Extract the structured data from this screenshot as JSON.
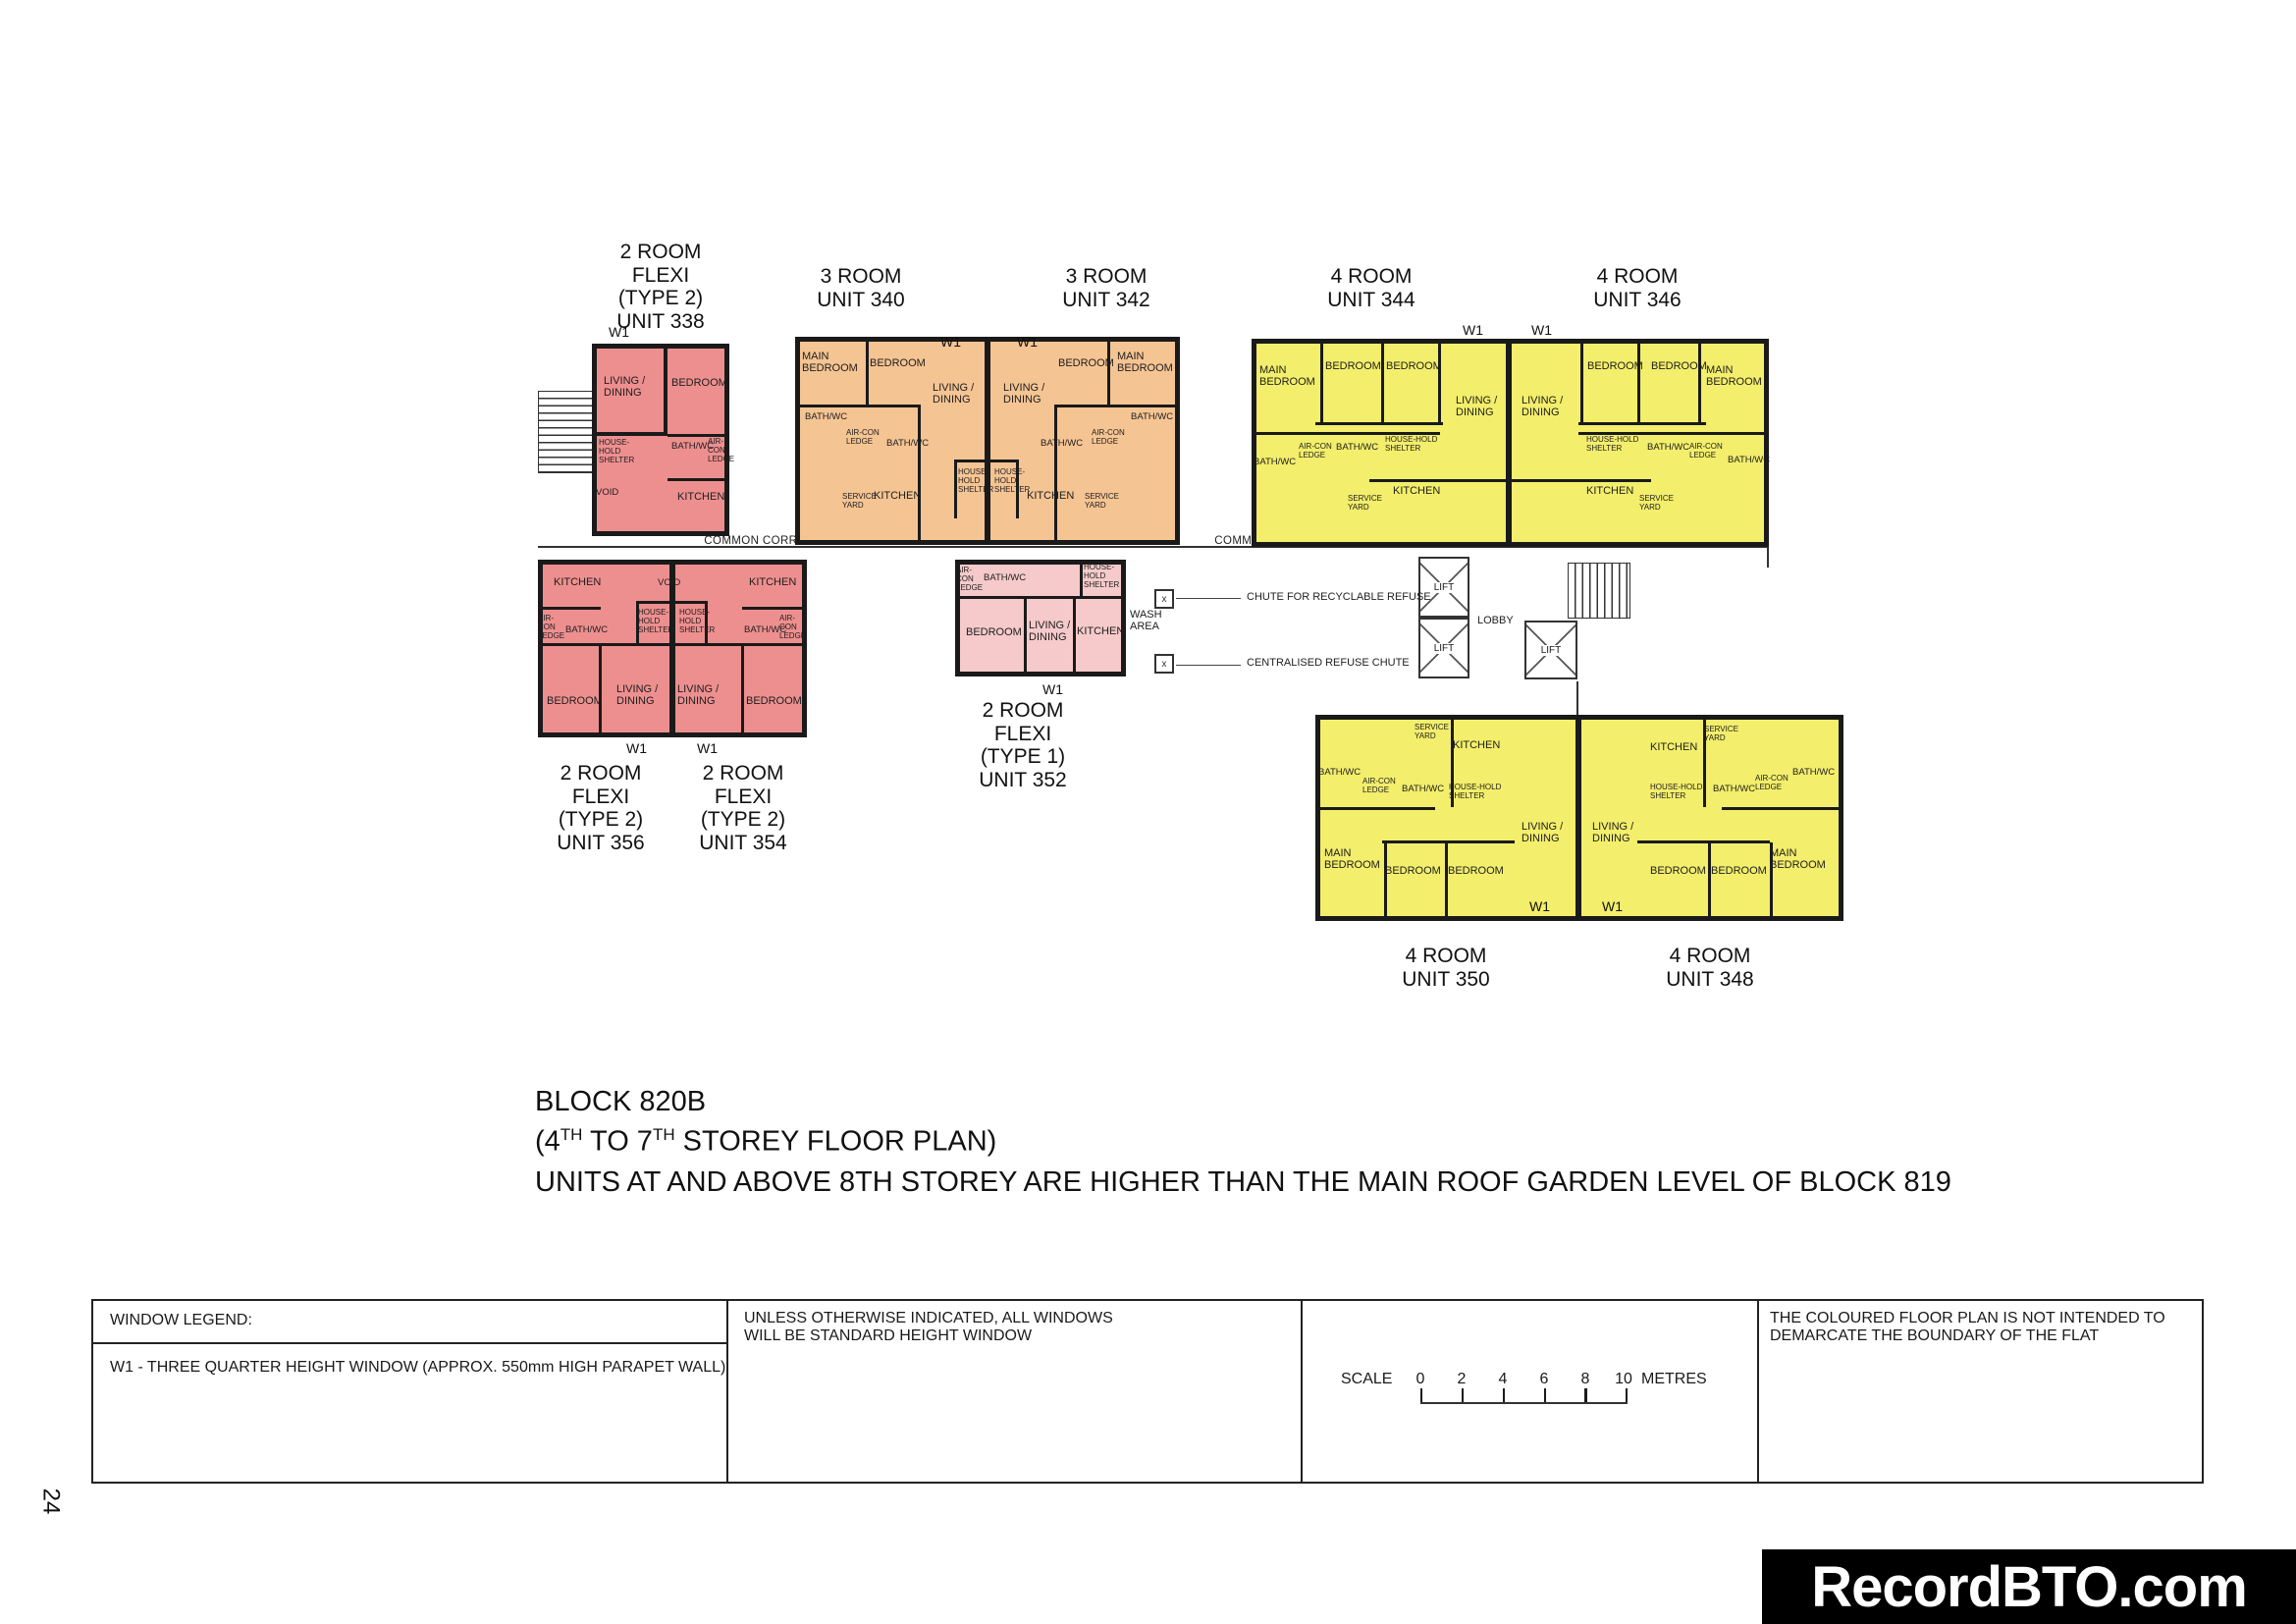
{
  "page": {
    "number": "24",
    "watermark": "RecordBTO.com"
  },
  "title": {
    "block": "BLOCK 820B",
    "storey_parts": [
      "(4",
      "TH",
      " TO 7",
      "TH",
      " STOREY FLOOR PLAN)"
    ],
    "note": "UNITS AT AND ABOVE 8TH STOREY ARE HIGHER THAN THE MAIN ROOF GARDEN LEVEL OF BLOCK 819"
  },
  "labels": {
    "living_dining": "LIVING /\nDINING",
    "bedroom": "BEDROOM",
    "main_bedroom": "MAIN\nBEDROOM",
    "kitchen": "KITCHEN",
    "bath_wc": "BATH/WC",
    "household_shelter": "HOUSE-HOLD\nSHELTER",
    "service_yard": "SERVICE\nYARD",
    "aircon_ledge": "AIR-CON\nLEDGE",
    "void": "VOID",
    "wash_area": "WASH\nAREA",
    "w1": "W1",
    "lift": "LIFT",
    "lobby": "LOBBY",
    "common_corridor": "COMMON CORRIDOR",
    "chute_recyclable": "CHUTE FOR RECYCLABLE REFUSE",
    "chute_centralised": "CENTRALISED REFUSE CHUTE",
    "chute_mark": "x"
  },
  "units": {
    "u338": {
      "caption": "2 ROOM\nFLEXI\n(TYPE 2)\nUNIT 338"
    },
    "u340": {
      "caption": "3 ROOM\nUNIT 340"
    },
    "u342": {
      "caption": "3 ROOM\nUNIT 342"
    },
    "u344": {
      "caption": "4 ROOM\nUNIT 344"
    },
    "u346": {
      "caption": "4 ROOM\nUNIT 346"
    },
    "u356": {
      "caption": "2 ROOM\nFLEXI\n(TYPE 2)\nUNIT 356"
    },
    "u354": {
      "caption": "2 ROOM\nFLEXI\n(TYPE 2)\nUNIT 354"
    },
    "u352": {
      "caption": "2 ROOM\nFLEXI\n(TYPE 1)\nUNIT 352"
    },
    "u350": {
      "caption": "4 ROOM\nUNIT 350"
    },
    "u348": {
      "caption": "4 ROOM\nUNIT 348"
    }
  },
  "legend": {
    "window_legend_title": "WINDOW LEGEND:",
    "w1_description": "W1 - THREE QUARTER HEIGHT WINDOW (APPROX. 550mm HIGH PARAPET WALL)",
    "windows_note": "UNLESS OTHERWISE INDICATED, ALL WINDOWS\nWILL BE STANDARD HEIGHT WINDOW",
    "scale": {
      "label": "SCALE",
      "ticks": [
        "0",
        "2",
        "4",
        "6",
        "8",
        "10"
      ],
      "unit": "METRES"
    },
    "coloured_note": "THE COLOURED FLOOR PLAN IS NOT INTENDED TO\nDEMARCATE THE BOUNDARY OF THE FLAT"
  },
  "colors": {
    "two_room_flexi_type2": "#ee8f8f",
    "two_room_flexi_type1": "#f6caca",
    "three_room": "#f5c493",
    "four_room": "#f3ee6b",
    "wall": "#1a1a1a",
    "watermark_bg": "#000000",
    "watermark_text": "#ffffff"
  }
}
